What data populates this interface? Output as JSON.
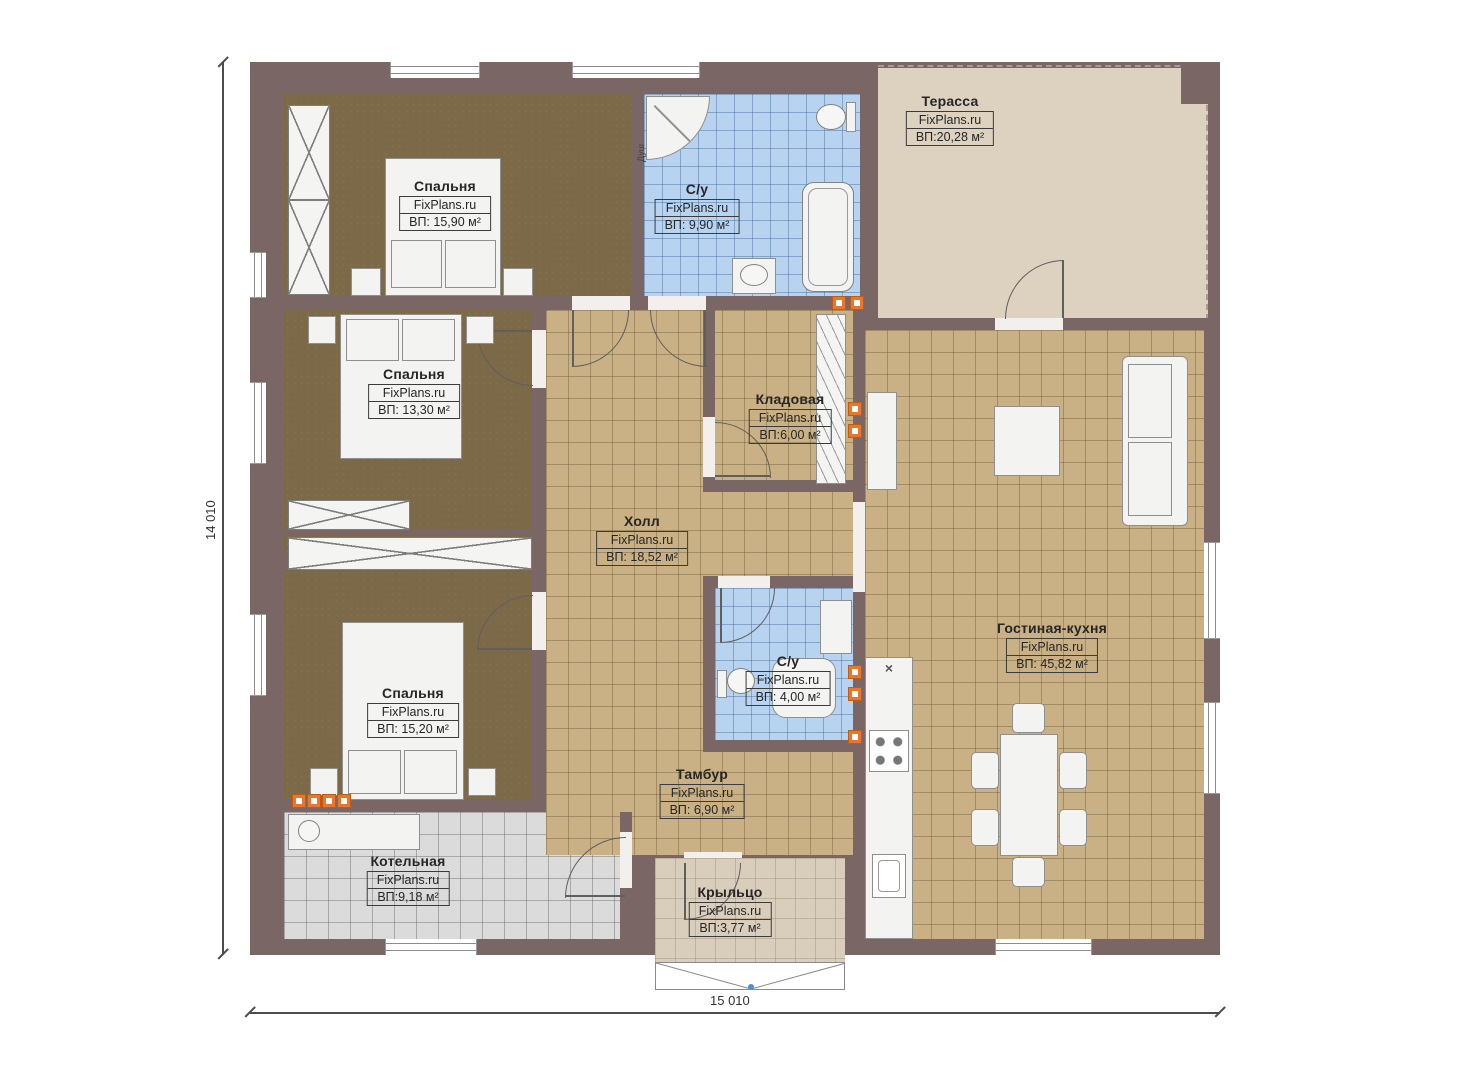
{
  "watermark": "FixPlans.ru",
  "dimensions": {
    "height": "14 010",
    "width": "15 010"
  },
  "rooms": [
    {
      "key": "bedroom-1",
      "name": "Спальня",
      "brand": "FixPlans.ru",
      "area": "ВП: 15,90 м²"
    },
    {
      "key": "bathroom-main",
      "name": "С/у",
      "brand": "FixPlans.ru",
      "area": "ВП: 9,90 м²"
    },
    {
      "key": "terrace",
      "name": "Терасса",
      "brand": "FixPlans.ru",
      "area": "ВП:20,28 м²"
    },
    {
      "key": "bedroom-2",
      "name": "Спальня",
      "brand": "FixPlans.ru",
      "area": "ВП: 13,30 м²"
    },
    {
      "key": "storage",
      "name": "Кладовая",
      "brand": "FixPlans.ru",
      "area": "ВП:6,00 м²"
    },
    {
      "key": "hall",
      "name": "Холл",
      "brand": "FixPlans.ru",
      "area": "ВП: 18,52 м²"
    },
    {
      "key": "bathroom-small",
      "name": "С/у",
      "brand": "FixPlans.ru",
      "area": "ВП: 4,00 м²"
    },
    {
      "key": "living-kitchen",
      "name": "Гостиная-кухня",
      "brand": "FixPlans.ru",
      "area": "ВП: 45,82 м²"
    },
    {
      "key": "bedroom-3",
      "name": "Спальня",
      "brand": "FixPlans.ru",
      "area": "ВП: 15,20 м²"
    },
    {
      "key": "tambour",
      "name": "Тамбур",
      "brand": "FixPlans.ru",
      "area": "ВП: 6,90 м²"
    },
    {
      "key": "boiler",
      "name": "Котельная",
      "brand": "FixPlans.ru",
      "area": "ВП:9,18 м²"
    },
    {
      "key": "porch",
      "name": "Крыльцо",
      "brand": "FixPlans.ru",
      "area": "ВП:3,77 м²"
    }
  ],
  "annotations": {
    "shower": "Душ",
    "vent_icon": "×"
  },
  "colors": {
    "wall": "#7a6665",
    "bedroom_floor": "#7b6948",
    "tile_tan": "#c9b185",
    "tile_blue": "#b7d3f0",
    "terrace_floor": "#ddd1bf",
    "tile_gray": "#dbdbdb",
    "porch_floor": "#d9cdbb",
    "accent_orange": "#e8762c"
  }
}
